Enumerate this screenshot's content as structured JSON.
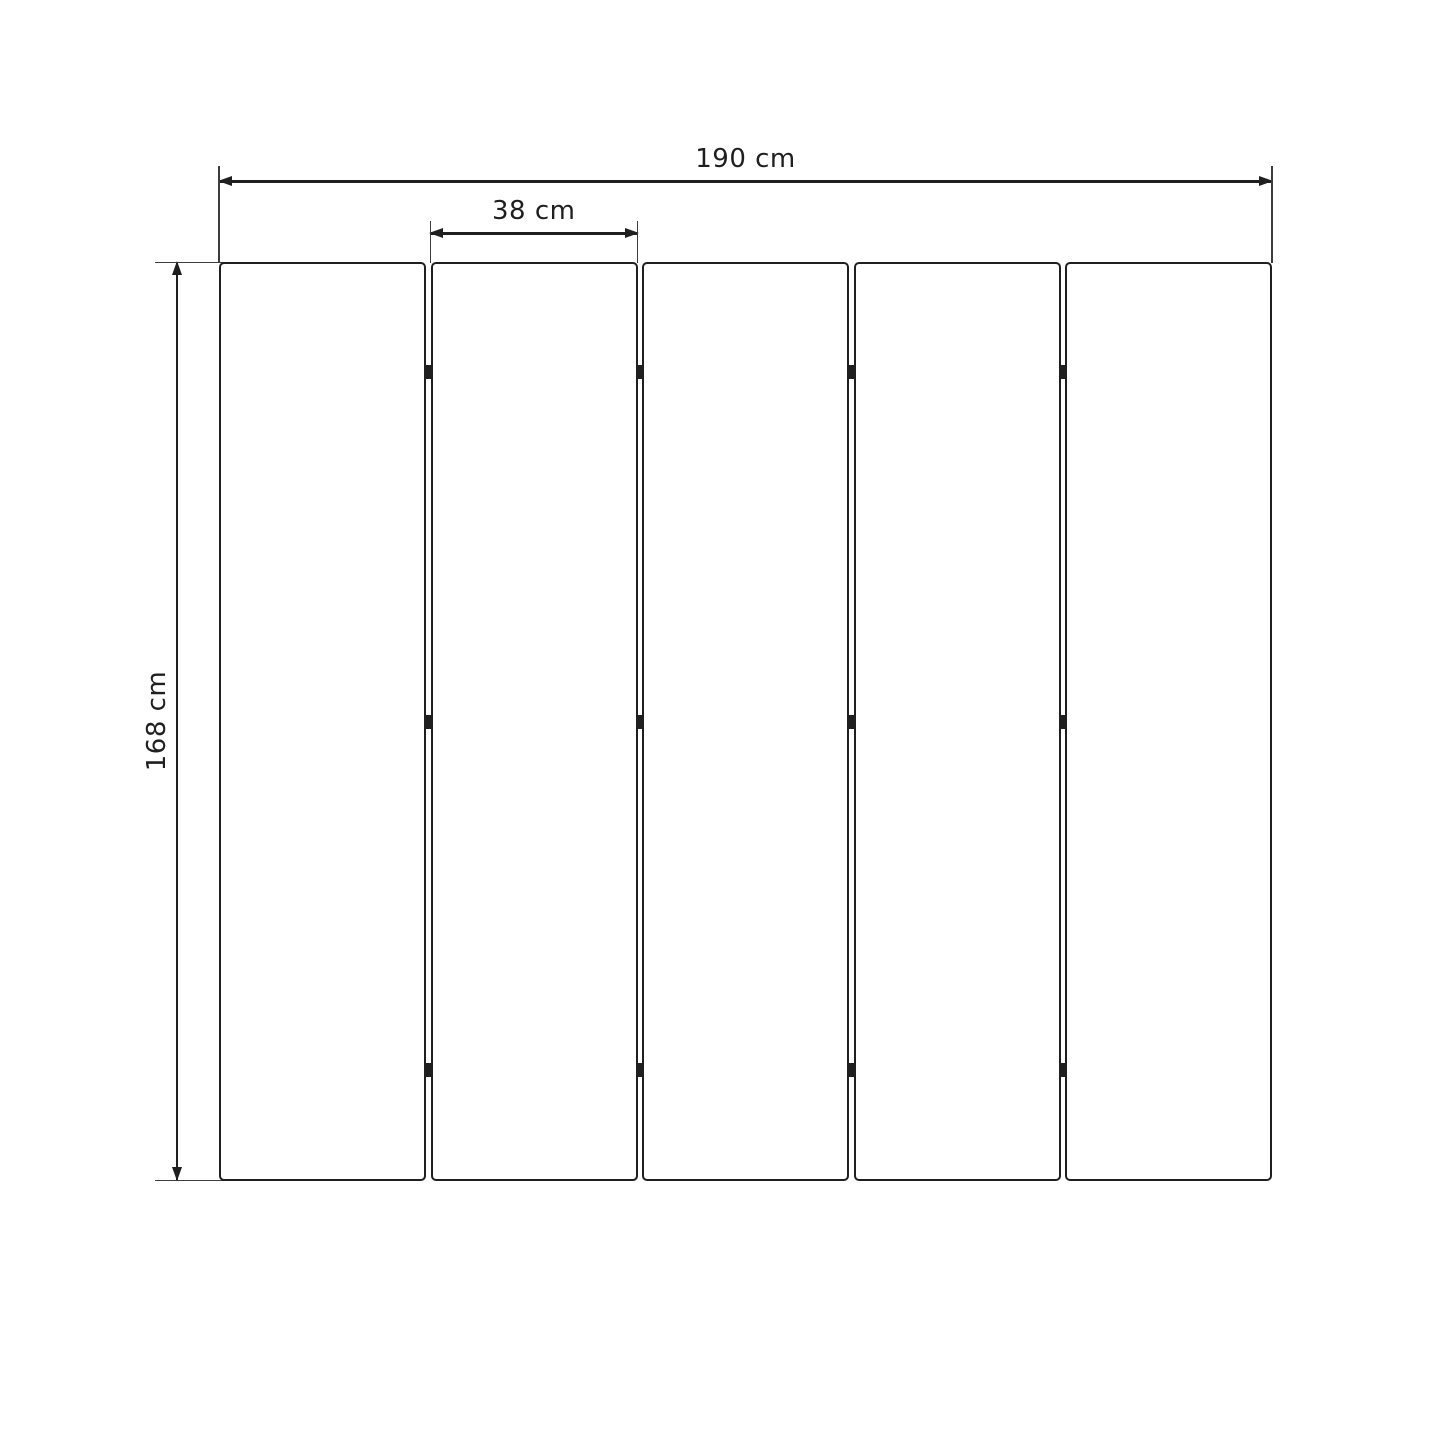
{
  "diagram": {
    "title": "panel-screen-dimension-drawing",
    "dimensions": {
      "total_width": {
        "label": "190 cm"
      },
      "panel_width": {
        "label": "38 cm"
      },
      "height": {
        "label": "168 cm"
      }
    },
    "panels": {
      "count": 5,
      "gaps": 4,
      "hinges_per_gap": 3
    },
    "colors": {
      "line": "#1f1f1f",
      "extension_line": "#3d3d3d",
      "background": "#ffffff",
      "panel_fill": "#ffffff"
    }
  }
}
